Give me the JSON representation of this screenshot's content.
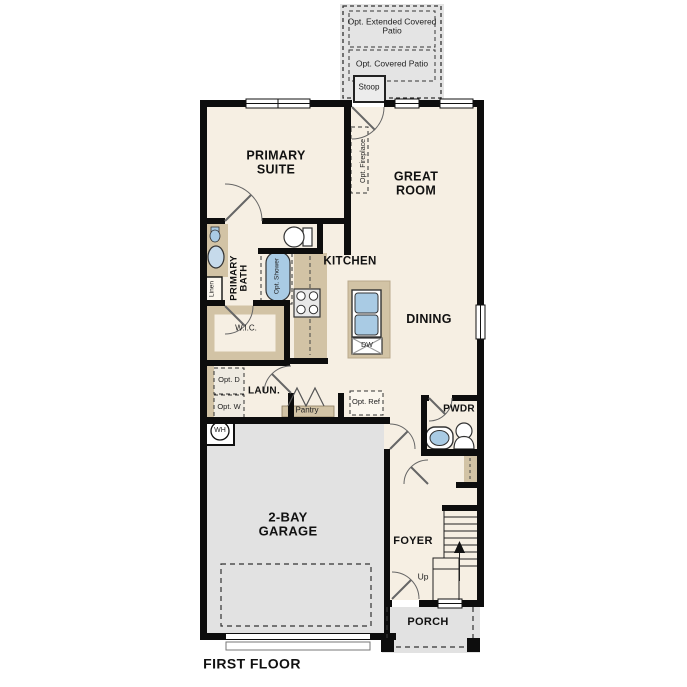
{
  "title": "FIRST FLOOR",
  "outdoor": {
    "extended_patio": "Opt. Extended Covered Patio",
    "covered_patio": "Opt. Covered Patio",
    "stoop": "Stoop",
    "porch": "PORCH"
  },
  "rooms": {
    "primary_suite": "PRIMARY SUITE",
    "great_room": "GREAT ROOM",
    "kitchen": "KITCHEN",
    "dining": "DINING",
    "primary_bath": "PRIMARY BATH",
    "wic": "W.I.C.",
    "laundry": "LAUN.",
    "pantry": "Pantry",
    "powder": "PWDR",
    "foyer": "FOYER",
    "garage": "2-BAY GARAGE"
  },
  "options": {
    "fireplace": "Opt. Fireplace",
    "shower": "Opt. Shower",
    "dryer": "Opt. D",
    "washer": "Opt. W",
    "refrigerator": "Opt. Ref"
  },
  "fixtures": {
    "water_heater": "WH",
    "dishwasher": "DW",
    "linen": "Linen",
    "stairs_up": "Up"
  },
  "colors": {
    "floor": "#F6EFE3",
    "garage_floor": "#E2E2E2",
    "cabinet": "#D2C3A5",
    "fixture_blue": "#A9CBE4",
    "wall": "#0D0D0D"
  }
}
